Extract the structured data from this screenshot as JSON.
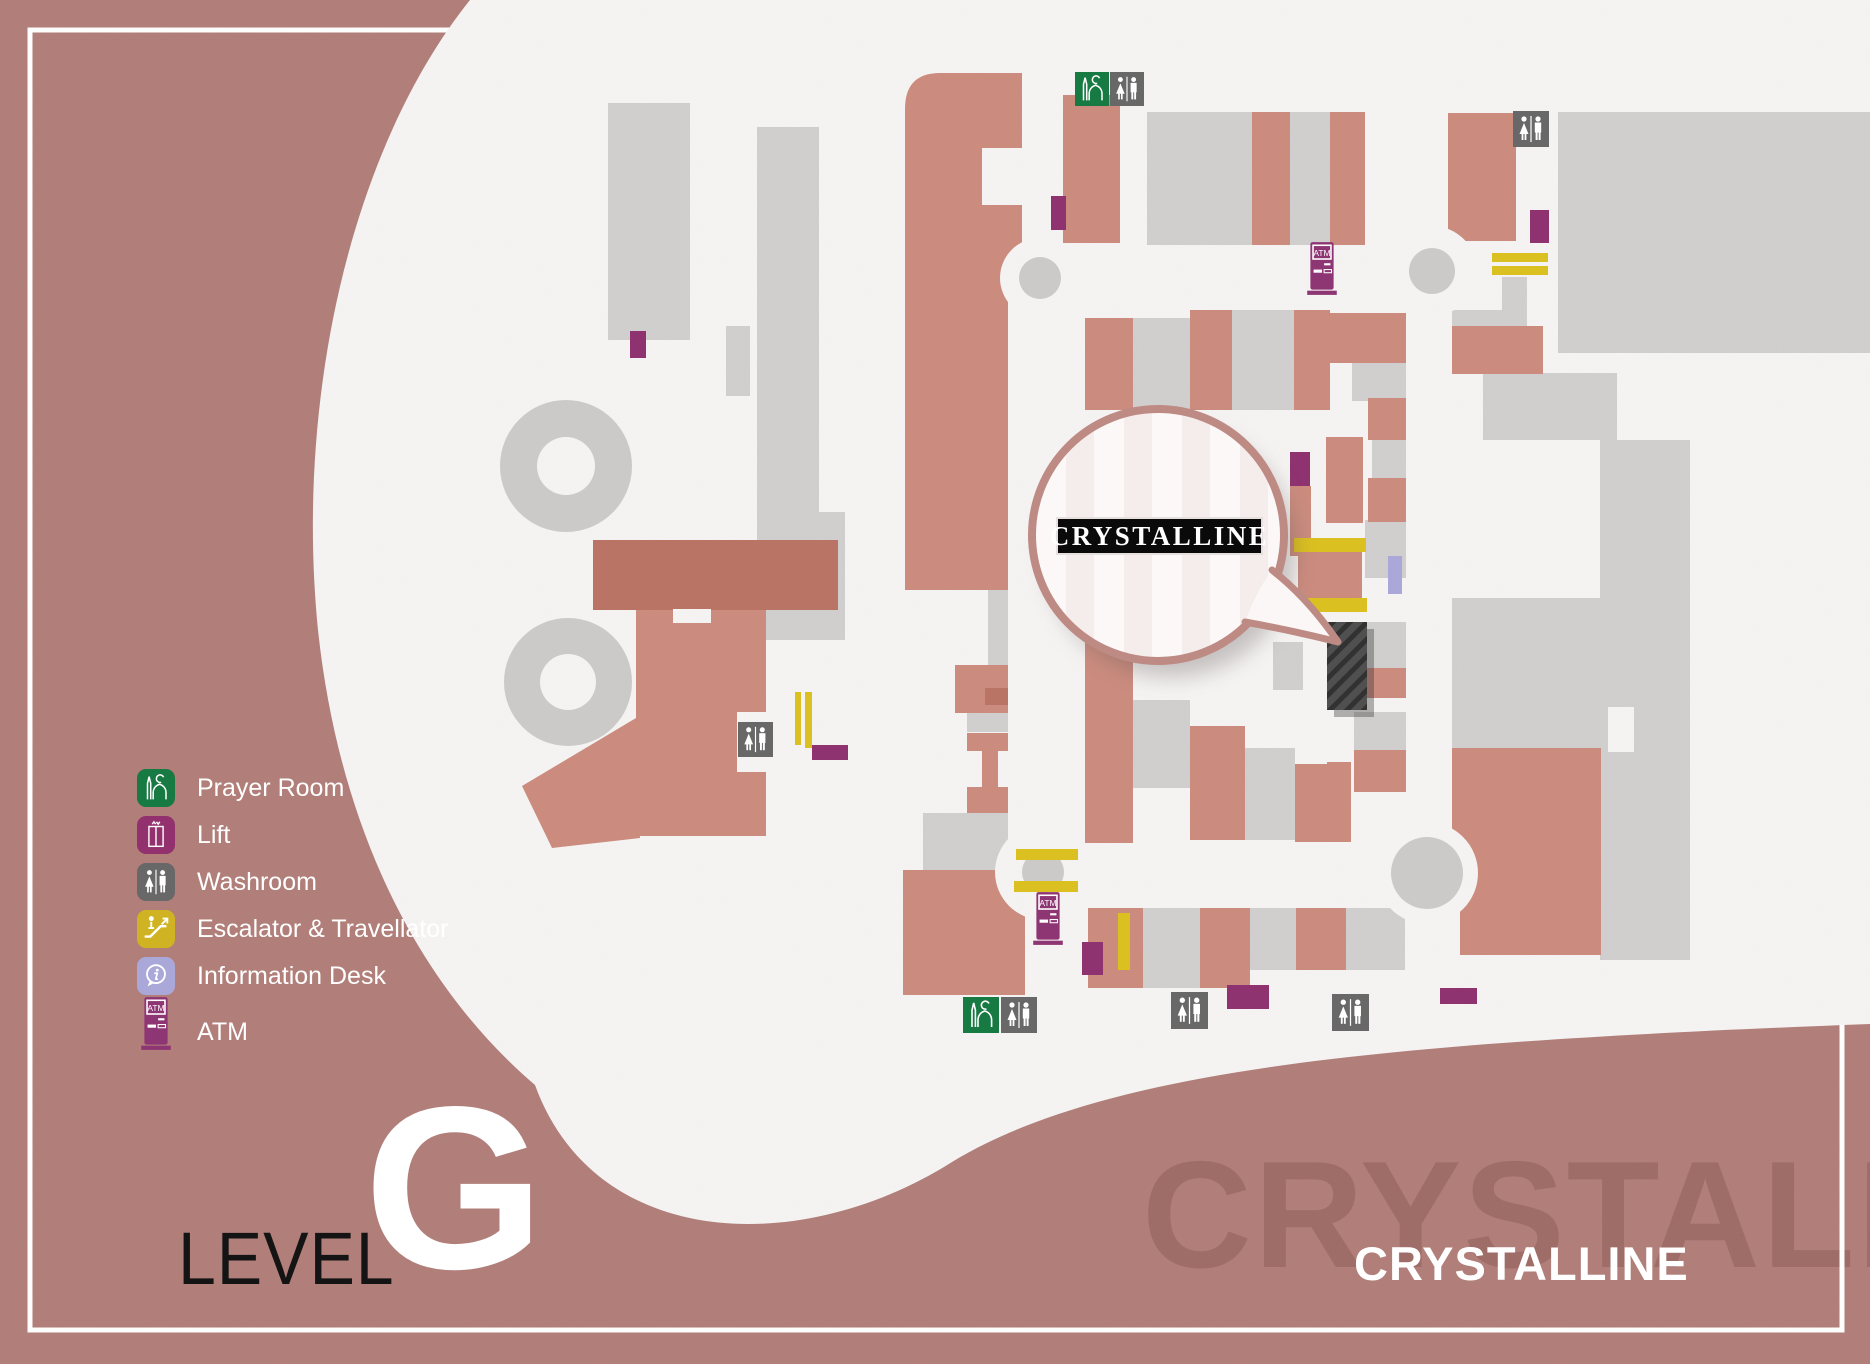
{
  "level": {
    "word": "LEVEL",
    "letter": "G"
  },
  "bubble": {
    "store_label": "CRYSTALLINE"
  },
  "footer": {
    "store_name": "CRYSTALLINE",
    "watermark": "CRYSTALLINE"
  },
  "map": {
    "atm_label": "ATM"
  },
  "legend": {
    "items": [
      {
        "icon": "prayer-room-icon",
        "label": "Prayer Room",
        "color": "#187a43"
      },
      {
        "icon": "lift-icon",
        "label": "Lift",
        "color": "#93316e"
      },
      {
        "icon": "washroom-icon",
        "label": "Washroom",
        "color": "#686868"
      },
      {
        "icon": "escalator-icon",
        "label": "Escalator & Travellator",
        "color": "#d0b322"
      },
      {
        "icon": "information-desk-icon",
        "label": "Information Desk",
        "color": "#aaa7d9"
      },
      {
        "icon": "atm-icon",
        "label": "ATM",
        "color": "#8e3573"
      }
    ]
  },
  "colors": {
    "background": "#b17d78",
    "walkway": "#f6f4f3",
    "store_salmon": "#cb8b7d",
    "store_salmon_dark": "#b97263",
    "store_gray": "#d0cfce",
    "marker_purple": "#8e2f6e",
    "marker_yellow": "#dcc01d",
    "marker_lavender": "#aaa7d9",
    "highlighted_store": "#4d4d4d",
    "bubble_border": "#bd8a84"
  }
}
